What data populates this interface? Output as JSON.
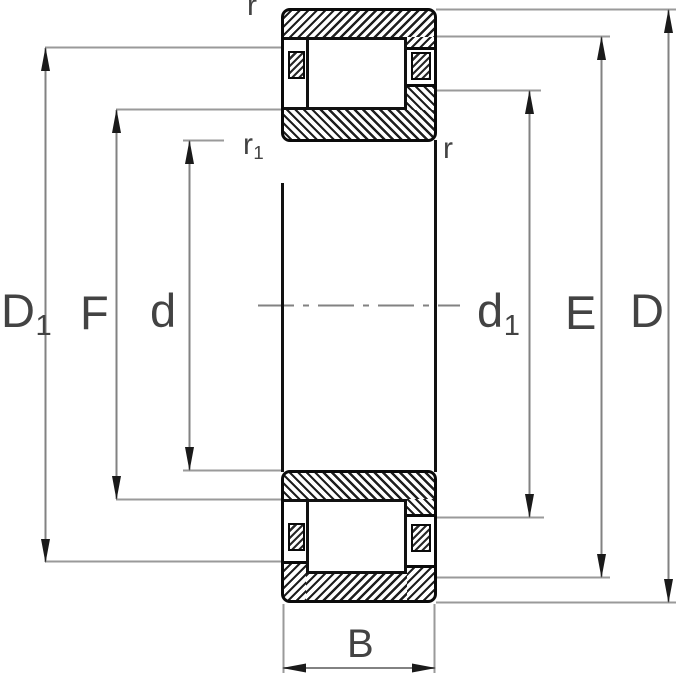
{
  "figure": {
    "kind": "cylindrical-roller-bearing-cross-section",
    "description": "Technical dimension drawing of a cylindrical roller bearing, sectioned above and below the horizontal axis"
  },
  "labels": {
    "D1": {
      "main": "D",
      "sub": "1"
    },
    "F": {
      "main": "F",
      "sub": ""
    },
    "d": {
      "main": "d",
      "sub": ""
    },
    "d1": {
      "main": "d",
      "sub": "1"
    },
    "E": {
      "main": "E",
      "sub": ""
    },
    "D": {
      "main": "D",
      "sub": ""
    },
    "B": {
      "main": "B",
      "sub": ""
    },
    "r_top": {
      "main": "r",
      "sub": ""
    },
    "r1": {
      "main": "r",
      "sub": "1"
    },
    "r_right": {
      "main": "r",
      "sub": ""
    }
  },
  "colors": {
    "background": "#ffffff",
    "part_outline": "#0a0a0a",
    "hatch": "#1f1f1f",
    "dimension_line": "#828282",
    "extension_line": "#9a9a9a",
    "arrow": "#1a1a1a",
    "label": "#434343"
  }
}
